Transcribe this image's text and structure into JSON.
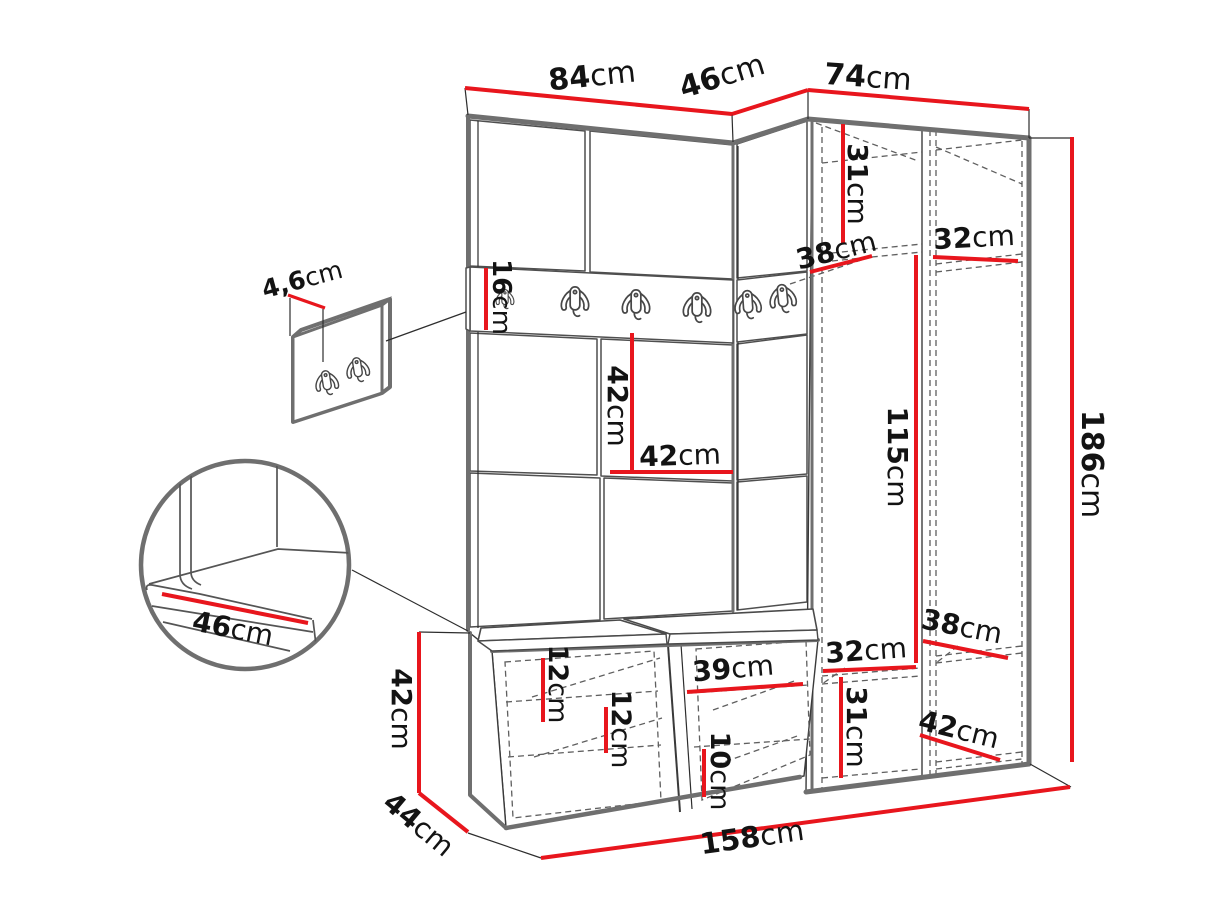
{
  "meta": {
    "title": "Hallway furniture set — dimension diagram",
    "unit": "cm",
    "diagram_type": "technical line drawing with red dimension lines"
  },
  "colors": {
    "dimension_red": "#e8161d",
    "edge_gray": "#6f6f6f",
    "line_dark": "#2e2e2e",
    "dashed_gray": "#5f5f5f",
    "background": "#ffffff",
    "text": "#131313"
  },
  "dims": {
    "w84": {
      "num": "84",
      "unit": "cm",
      "meaning": "left wall section width"
    },
    "w46top": {
      "num": "46",
      "unit": "cm",
      "meaning": "corner section width"
    },
    "w74": {
      "num": "74",
      "unit": "cm",
      "meaning": "wardrobe width"
    },
    "h186": {
      "num": "186",
      "unit": "cm",
      "meaning": "total height"
    },
    "h31top": {
      "num": "31",
      "unit": "cm",
      "meaning": "top shelf spacing"
    },
    "d38top": {
      "num": "38",
      "unit": "cm",
      "meaning": "upper left compartment depth"
    },
    "w32top": {
      "num": "32",
      "unit": "cm",
      "meaning": "upper right shelf width"
    },
    "h16": {
      "num": "16",
      "unit": "cm",
      "meaning": "hook rail height"
    },
    "h42wall": {
      "num": "42",
      "unit": "cm",
      "meaning": "wall panel height"
    },
    "w42wall": {
      "num": "42",
      "unit": "cm",
      "meaning": "wall panel width"
    },
    "h115": {
      "num": "115",
      "unit": "cm",
      "meaning": "hanging space height"
    },
    "w32low": {
      "num": "32",
      "unit": "cm",
      "meaning": "lower left shelf width"
    },
    "d38low": {
      "num": "38",
      "unit": "cm",
      "meaning": "lower right shelf depth"
    },
    "h31low": {
      "num": "31",
      "unit": "cm",
      "meaning": "lower shelf spacing"
    },
    "d42low": {
      "num": "42",
      "unit": "cm",
      "meaning": "bottom shelf depth"
    },
    "h12a": {
      "num": "12",
      "unit": "cm",
      "meaning": "bench shelf spacing"
    },
    "h12b": {
      "num": "12",
      "unit": "cm",
      "meaning": "bench shelf spacing"
    },
    "w39": {
      "num": "39",
      "unit": "cm",
      "meaning": "bench compartment width"
    },
    "h10": {
      "num": "10",
      "unit": "cm",
      "meaning": "bench bottom shelf spacing"
    },
    "h42left": {
      "num": "42",
      "unit": "cm",
      "meaning": "bench height"
    },
    "d44": {
      "num": "44",
      "unit": "cm",
      "meaning": "bench depth"
    },
    "w158": {
      "num": "158",
      "unit": "cm",
      "meaning": "total width"
    },
    "t46panel": {
      "num": "4,6",
      "unit": "cm",
      "meaning": "hanger panel thickness"
    },
    "w46seat": {
      "num": "46",
      "unit": "cm",
      "meaning": "seat cushion depth"
    }
  },
  "details": {
    "rail_hook_count": 6,
    "wall_hanger_hook_count": 2,
    "bench_cushion_count": 2,
    "wardrobe_sections": 2,
    "bench_doors": 2
  }
}
